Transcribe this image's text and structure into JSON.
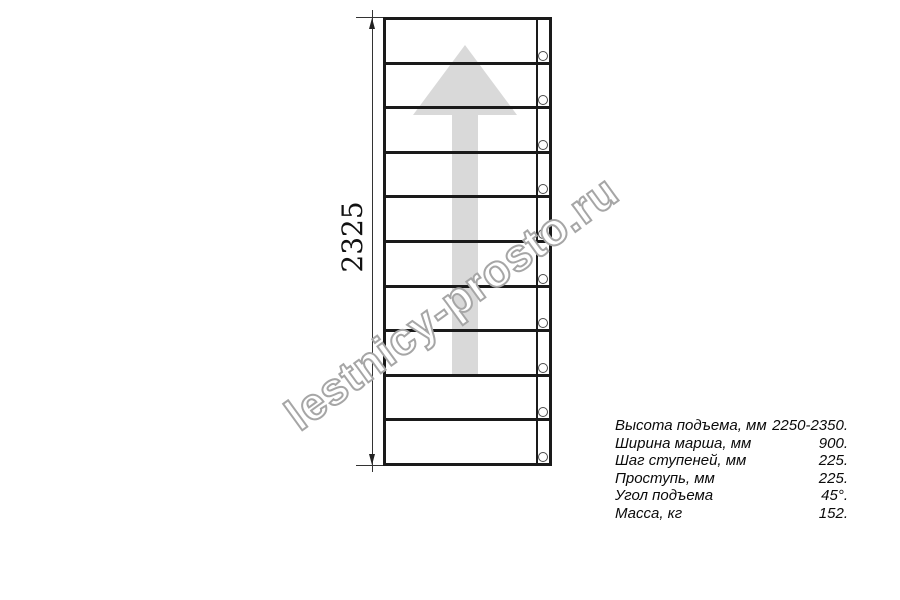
{
  "watermark": {
    "text": "lestnicy-prosto.ru"
  },
  "drawing": {
    "height_dimension_label": "2325",
    "step_count": 10,
    "fastener_count": 10,
    "direction_arrow": "up"
  },
  "specs": {
    "rows": [
      {
        "label": "Высота подъема, мм",
        "value": "2250-2350."
      },
      {
        "label": "Ширина марша, мм",
        "value": "900."
      },
      {
        "label": "Шаг ступеней, мм",
        "value": "225."
      },
      {
        "label": "Проступь, мм",
        "value": "225."
      },
      {
        "label": "Угол подъема",
        "value": "45°."
      },
      {
        "label": "Масса, кг",
        "value": "152."
      }
    ]
  },
  "colors": {
    "line": "#1a1a1a",
    "arrow_fill": "#d9d9d9",
    "watermark_outline": "#a6a6a6",
    "background": "#ffffff"
  }
}
